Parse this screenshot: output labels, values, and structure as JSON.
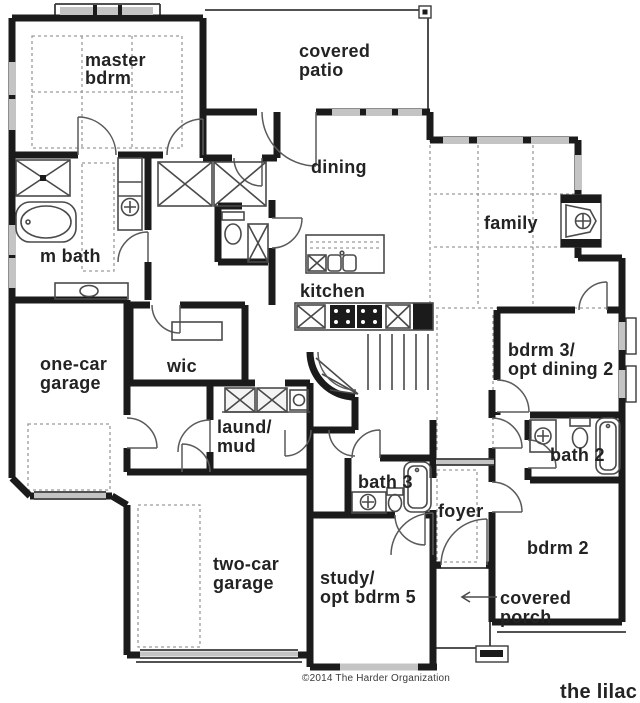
{
  "plan": {
    "name": "the lilac",
    "copyright": "©2014 The Harder Organization"
  },
  "colors": {
    "wall": "#1b1b1b",
    "window_glass": "#c4c4c4",
    "ceiling_dash": "#9a9a9a",
    "background": "#ffffff"
  },
  "rooms": {
    "master_bdrm": {
      "line1": "master",
      "line2": "bdrm"
    },
    "covered_patio": {
      "line1": "covered",
      "line2": "patio"
    },
    "dining": {
      "label": "dining"
    },
    "family": {
      "label": "family"
    },
    "m_bath": {
      "label": "m bath"
    },
    "kitchen": {
      "label": "kitchen"
    },
    "wic": {
      "label": "wic"
    },
    "one_car_garage": {
      "line1": "one-car",
      "line2": "garage"
    },
    "laund_mud": {
      "line1": "laund/",
      "line2": "mud"
    },
    "bdrm3": {
      "line1": "bdrm 3/",
      "line2": "opt dining 2"
    },
    "bath2": {
      "label": "bath 2"
    },
    "bath3": {
      "label": "bath 3"
    },
    "foyer": {
      "label": "foyer"
    },
    "bdrm2": {
      "label": "bdrm 2"
    },
    "two_car_garage": {
      "line1": "two-car",
      "line2": "garage"
    },
    "study": {
      "line1": "study/",
      "line2": "opt bdrm 5"
    },
    "covered_porch": {
      "line1": "covered",
      "line2": "porch"
    }
  }
}
